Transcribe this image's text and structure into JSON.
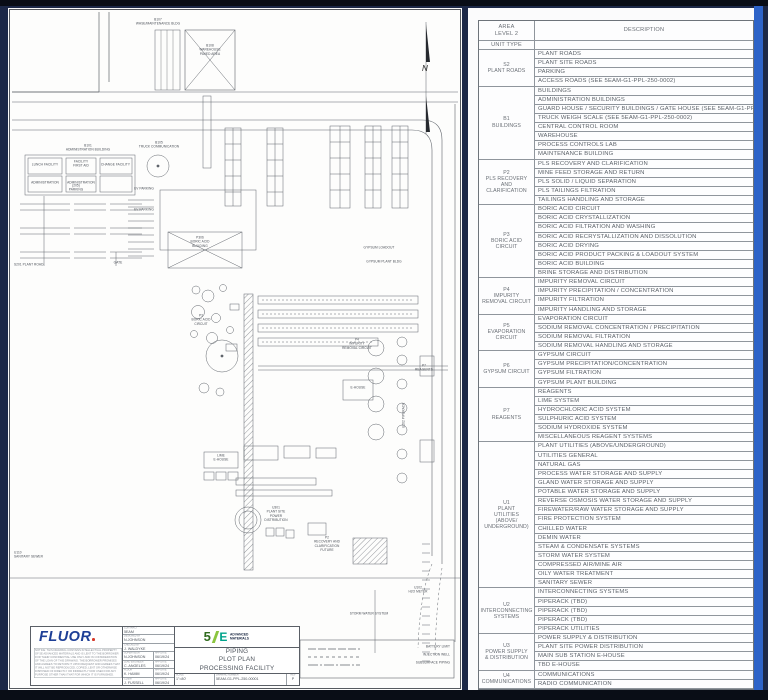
{
  "colors": {
    "frame_navy": "#1c2847",
    "accent_blue": "#2d63c8",
    "fluor_blue": "#1e3f96",
    "fluor_dot_red": "#d6382a",
    "brand_green": "#8bc53f",
    "brand_teal": "#00a38b",
    "paper": "#fdfdfc",
    "line_gray": "#8f959c"
  },
  "drawing": {
    "labels": [
      "B107\nWHSE/MAINTENANCE BLDG",
      "B108\nWAREHOUSE\nPAVED AREA",
      "B101\nADMINISTRATION BUILDING",
      "B105\nTRUCK COMMUNICATION",
      "LUNCH FACILITY",
      "FACILITY\nFIRST AID",
      "CHANGE FACILITY",
      "ADMINISTRATION",
      "ADMINISTRATION",
      "EV PARKING",
      "(205)\nPARKING",
      "EV PARKING",
      "GATE",
      "S201 PLANT ROAD",
      "N",
      "P306\nBORIC ACID\nBUILDING",
      "P3\nBORIC ACID\nCIRCUIT",
      "GYPSUM LOADOUT",
      "GYPSUM PLANT BLDG",
      "P4\nIMPURITY\nREMOVAL CIRCUIT",
      "U202 PIPERACK",
      "E-HOUSE",
      "P7\nREAGENTS",
      "LIME\nE-HOUSE",
      "U301\nPLANT SITE\nPOWER\nDISTRIBUTION",
      "U110\nSANITARY SEWER",
      "P2\nRECOVERY AND\nCLARIFICATION\nFUTURE",
      "U102\nH2O METER",
      "STORM WATER SYSTEM",
      "BATTERY LIMIT",
      "INJECTION WELL",
      "SUBSURFACE PIPING"
    ],
    "title_block": {
      "logo": "FLUOR",
      "notice": "NOTICE: THIS DRAWING CONTAINS INTELLECTUAL PROPERTY OF 5E ADVANCED MATERIALS AND IS LENT TO THE BORROWER FOR THEIR CONFIDENTIAL USE ONLY AND IN CONSIDERATION OF THE LOAN OF THIS DRAWING. THE BORROWER PROMISES AND AGREES TO RETURN IT UPON REQUEST AND AGREES THAT IT WILL NOT BE REPRODUCED, COPIED, LENT OR OTHERWISE DISPOSED OF DIRECTLY OR INDIRECTLY NOR USED FOR ANY PURPOSE OTHER THAN THAT FOR WHICH IT IS FURNISHED.",
      "app_date_label": "APP DATE",
      "fields": [
        {
          "label": "CONTRACT",
          "value": "5EAM"
        },
        {
          "label": "DESIGNED BY",
          "value": "N.JOHNSON"
        },
        {
          "label": "CHECKED BY",
          "value": "J. WALDYKE"
        },
        {
          "label": "SUPERVISOR",
          "value": "N.JOHNSON",
          "date": "06/19/24"
        },
        {
          "label": "LEAD ENGINEER",
          "value": "C. ANGELES",
          "date": "06/19/24"
        },
        {
          "label": "FLUOR",
          "value": "K. HAMM",
          "date": "06/19/24"
        },
        {
          "label": "CLIENT",
          "value": "J. FUSSELL",
          "date": "06/19/24"
        }
      ],
      "brand": {
        "five": "5",
        "e": "E",
        "name": "ADVANCED\nMATERIALS"
      },
      "title": "PIPING\nPLOT PLAN\nPROCESSING FACILITY",
      "scale_label": "SCALE",
      "scale": "1\"=80'",
      "drawing_number_label": "DRAWING NUMBER",
      "drawing_number": "5EAM-G1-PPL-250-00001",
      "rev_label": "REV",
      "rev": "P"
    }
  },
  "legend_table": {
    "header": {
      "col1": "AREA\nLEVEL 2",
      "col1b": "UNIT TYPE",
      "col2": "DESCRIPTION"
    },
    "groups": [
      {
        "code": "S2",
        "name": "PLANT ROADS",
        "rows": [
          "PLANT ROADS",
          "PLANT SITE ROADS",
          "PARKING",
          "ACCESS ROADS (SEE 5EAM-G1-PPL-250-0002)"
        ]
      },
      {
        "code": "B1",
        "name": "BUILDINGS",
        "rows": [
          "BUILDINGS",
          "ADMINISTRATION BUILDINGS",
          "GUARD HOUSE / SECURITY BUILDINGS / GATE HOUSE (SEE 5EAM-G1-PPL-250-0002)",
          "TRUCK WEIGH SCALE (SEE 5EAM-G1-PPL-250-0002)",
          "CENTRAL CONTROL ROOM",
          "WAREHOUSE",
          "PROCESS CONTROLS LAB",
          "MAINTENANCE BUILDING"
        ]
      },
      {
        "code": "P2",
        "name": "PLS RECOVERY\nAND\nCLARIFICATION",
        "rows": [
          "PLS RECOVERY AND CLARIFICATION",
          "MINE FEED STORAGE AND RETURN",
          "PLS SOLID / LIQUID SEPARATION",
          "PLS TAILINGS FILTRATION",
          "TAILINGS HANDLING AND STORAGE"
        ]
      },
      {
        "code": "P3",
        "name": "BORIC ACID\nCIRCUIT",
        "rows": [
          "BORIC ACID CIRCUIT",
          "BORIC ACID CRYSTALLIZATION",
          "BORIC ACID FILTRATION AND WASHING",
          "BORIC ACID RECRYSTALLIZATION AND DISSOLUTION",
          "BORIC ACID DRYING",
          "BORIC ACID PRODUCT PACKING & LOADOUT SYSTEM",
          "BORIC ACID BUILDING",
          "BRINE STORAGE AND DISTRIBUTION"
        ]
      },
      {
        "code": "P4",
        "name": "IMPURITY\nREMOVAL CIRCUIT",
        "rows": [
          "IMPURITY REMOVAL CIRCUIT",
          "IMPURITY PRECIPITATION / CONCENTRATION",
          "IMPURITY FILTRATION",
          "IMPURITY HANDLING AND STORAGE"
        ]
      },
      {
        "code": "P5",
        "name": "EVAPORATION\nCIRCUIT",
        "rows": [
          "EVAPORATION CIRCUIT",
          "SODIUM REMOVAL CONCENTRATION / PRECIPITATION",
          "SODIUM REMOVAL FILTRATION",
          "SODIUM REMOVAL HANDLING AND STORAGE"
        ]
      },
      {
        "code": "P6",
        "name": "GYPSUM CIRCUIT",
        "rows": [
          "GYPSUM CIRCUIT",
          "GYPSUM PRECIPITATION/CONCENTRATION",
          "GYPSUM FILTRATION",
          "GYPSUM PLANT BUILDING"
        ]
      },
      {
        "code": "P7",
        "name": "REAGENTS",
        "rows": [
          "REAGENTS",
          "LIME SYSTEM",
          "HYDROCHLORIC ACID SYSTEM",
          "SULPHURIC ACID SYSTEM",
          "SODIUM HYDROXIDE SYSTEM",
          "MISCELLANEOUS REAGENT SYSTEMS"
        ]
      },
      {
        "code": "U1",
        "name": "PLANT\nUTILITIES\n(ABOVE/\nUNDERGROUND)",
        "rows": [
          "PLANT UTILITIES (ABOVE/UNDERGROUND)",
          "UTILITIES GENERAL",
          "NATURAL GAS",
          "PROCESS WATER STORAGE AND SUPPLY",
          "GLAND WATER STORAGE AND SUPPLY",
          "POTABLE WATER STORAGE AND SUPPLY",
          "REVERSE OSMOSIS WATER STORAGE AND SUPPLY",
          "FIREWATER/RAW WATER STORAGE AND SUPPLY",
          "FIRE PROTECTION SYSTEM",
          "CHILLED WATER",
          "DEMIN WATER",
          "STEAM & CONDENSATE SYSTEMS",
          "STORM WATER SYSTEM",
          "COMPRESSED AIR/MINE AIR",
          "OILY WATER TREATMENT",
          "SANITARY SEWER"
        ]
      },
      {
        "code": "U2",
        "name": "INTERCONNECTING\nSYSTEMS",
        "rows": [
          "INTERCONNECTING SYSTEMS",
          "PIPERACK (TBD)",
          "PIPERACK (TBD)",
          "PIPERACK (TBD)",
          "PIPERACK UTILITIES"
        ]
      },
      {
        "code": "U3",
        "name": "POWER SUPPLY\n& DISTRIBUTION",
        "rows": [
          "POWER SUPPLY & DISTRIBUTION",
          "PLANT SITE POWER DISTRIBUTION",
          "MAIN SUB STATION E-HOUSE",
          "TBD E-HOUSE"
        ]
      },
      {
        "code": "U4",
        "name": "COMMUNICATIONS",
        "rows": [
          "COMMUNICATIONS",
          "RADIO COMMUNICATION"
        ]
      }
    ]
  }
}
